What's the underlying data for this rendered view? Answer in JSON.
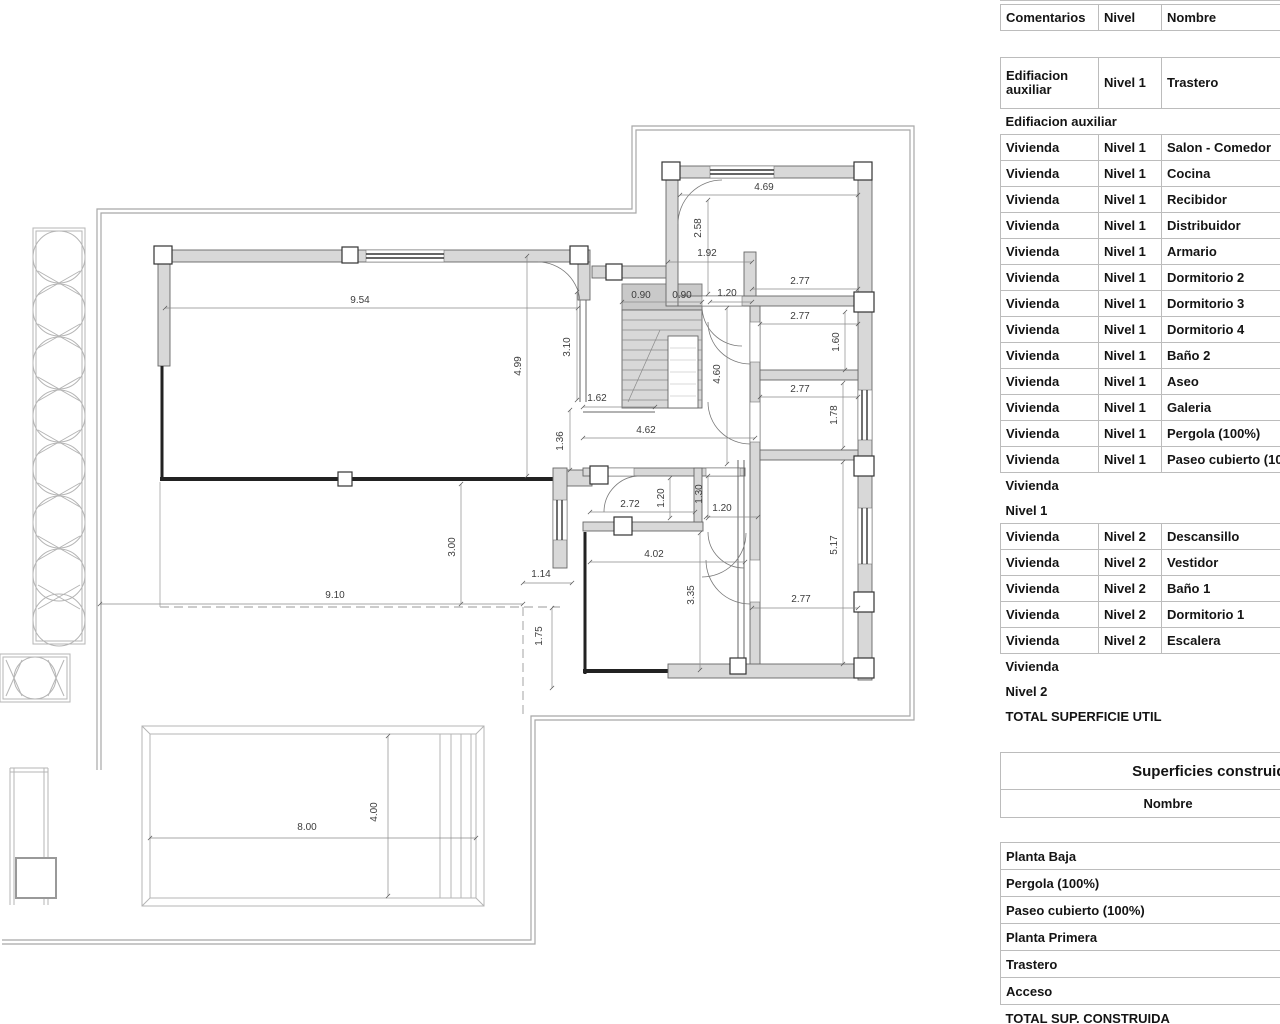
{
  "colors": {
    "wall_fill": "#d8d8d8",
    "stair_fill": "#c9c9c9",
    "line_gray": "#999999",
    "table_border": "#bcbcbc",
    "text": "#141414"
  },
  "floorplan": {
    "dim_labels": [
      {
        "t": "9.54",
        "x": 360,
        "y": 303
      },
      {
        "t": "4.99",
        "x": 521,
        "y": 366,
        "r": 1
      },
      {
        "t": "3.10",
        "x": 570,
        "y": 347,
        "r": 1
      },
      {
        "t": "1.62",
        "x": 597,
        "y": 401
      },
      {
        "t": "1.36",
        "x": 563,
        "y": 441,
        "r": 1
      },
      {
        "t": "4.62",
        "x": 646,
        "y": 433
      },
      {
        "t": "0.90",
        "x": 641,
        "y": 298
      },
      {
        "t": "0.90",
        "x": 682,
        "y": 298
      },
      {
        "t": "1.20",
        "x": 727,
        "y": 296
      },
      {
        "t": "1.92",
        "x": 707,
        "y": 256
      },
      {
        "t": "4.69",
        "x": 764,
        "y": 190
      },
      {
        "t": "2.58",
        "x": 701,
        "y": 228,
        "r": 1
      },
      {
        "t": "2.77",
        "x": 800,
        "y": 284
      },
      {
        "t": "2.77",
        "x": 800,
        "y": 319
      },
      {
        "t": "1.60",
        "x": 839,
        "y": 342,
        "r": 1
      },
      {
        "t": "2.77",
        "x": 800,
        "y": 392
      },
      {
        "t": "1.78",
        "x": 837,
        "y": 415,
        "r": 1
      },
      {
        "t": "4.60",
        "x": 720,
        "y": 374,
        "r": 1
      },
      {
        "t": "2.72",
        "x": 630,
        "y": 507
      },
      {
        "t": "1.20",
        "x": 664,
        "y": 498,
        "r": 1
      },
      {
        "t": "1.30",
        "x": 702,
        "y": 494,
        "r": 1
      },
      {
        "t": "1.20",
        "x": 722,
        "y": 511
      },
      {
        "t": "4.02",
        "x": 654,
        "y": 557
      },
      {
        "t": "3.35",
        "x": 694,
        "y": 595,
        "r": 1
      },
      {
        "t": "2.77",
        "x": 801,
        "y": 602
      },
      {
        "t": "5.17",
        "x": 837,
        "y": 545,
        "r": 1
      },
      {
        "t": "3.00",
        "x": 455,
        "y": 547,
        "r": 1
      },
      {
        "t": "9.10",
        "x": 335,
        "y": 598
      },
      {
        "t": "1.14",
        "x": 541,
        "y": 577
      },
      {
        "t": "1.75",
        "x": 542,
        "y": 636,
        "r": 1
      },
      {
        "t": "8.00",
        "x": 307,
        "y": 830
      },
      {
        "t": "4.00",
        "x": 377,
        "y": 812,
        "r": 1
      }
    ]
  },
  "room_schedule": {
    "columns": [
      "Comentarios",
      "Nivel",
      "Nombre"
    ],
    "rows": [
      {
        "type": "data",
        "tall": true,
        "cells": [
          "Edifiacion auxiliar",
          "Nivel 1",
          "Trastero"
        ]
      },
      {
        "type": "group",
        "label": "Edifiacion auxiliar"
      },
      {
        "type": "data",
        "cells": [
          "Vivienda",
          "Nivel 1",
          "Salon - Comedor"
        ]
      },
      {
        "type": "data",
        "cells": [
          "Vivienda",
          "Nivel 1",
          "Cocina"
        ]
      },
      {
        "type": "data",
        "cells": [
          "Vivienda",
          "Nivel 1",
          "Recibidor"
        ]
      },
      {
        "type": "data",
        "cells": [
          "Vivienda",
          "Nivel 1",
          "Distribuidor"
        ]
      },
      {
        "type": "data",
        "cells": [
          "Vivienda",
          "Nivel 1",
          "Armario"
        ]
      },
      {
        "type": "data",
        "cells": [
          "Vivienda",
          "Nivel 1",
          "Dormitorio 2"
        ]
      },
      {
        "type": "data",
        "cells": [
          "Vivienda",
          "Nivel 1",
          "Dormitorio 3"
        ]
      },
      {
        "type": "data",
        "cells": [
          "Vivienda",
          "Nivel 1",
          "Dormitorio 4"
        ]
      },
      {
        "type": "data",
        "cells": [
          "Vivienda",
          "Nivel 1",
          "Baño 2"
        ]
      },
      {
        "type": "data",
        "cells": [
          "Vivienda",
          "Nivel 1",
          "Aseo"
        ]
      },
      {
        "type": "data",
        "cells": [
          "Vivienda",
          "Nivel 1",
          "Galeria"
        ]
      },
      {
        "type": "data",
        "cells": [
          "Vivienda",
          "Nivel 1",
          "Pergola (100%)"
        ]
      },
      {
        "type": "data",
        "cells": [
          "Vivienda",
          "Nivel 1",
          "Paseo cubierto (100%)"
        ]
      },
      {
        "type": "group",
        "label": "Vivienda"
      },
      {
        "type": "group",
        "label": "Nivel 1"
      },
      {
        "type": "data",
        "cells": [
          "Vivienda",
          "Nivel 2",
          "Descansillo"
        ]
      },
      {
        "type": "data",
        "cells": [
          "Vivienda",
          "Nivel 2",
          "Vestidor"
        ]
      },
      {
        "type": "data",
        "cells": [
          "Vivienda",
          "Nivel 2",
          "Baño 1"
        ]
      },
      {
        "type": "data",
        "cells": [
          "Vivienda",
          "Nivel 2",
          "Dormitorio 1"
        ]
      },
      {
        "type": "data",
        "cells": [
          "Vivienda",
          "Nivel 2",
          "Escalera"
        ]
      },
      {
        "type": "group",
        "label": "Vivienda"
      },
      {
        "type": "group",
        "label": "Nivel 2"
      },
      {
        "type": "total",
        "label": "TOTAL SUPERFICIE UTIL"
      }
    ]
  },
  "built_areas": {
    "title": "Superficies construida",
    "column": "Nombre",
    "rows": [
      "Planta Baja",
      "Pergola (100%)",
      "Paseo cubierto (100%)",
      "Planta Primera",
      "Trastero",
      "Acceso"
    ],
    "total_label": "TOTAL SUP. CONSTRUIDA"
  }
}
